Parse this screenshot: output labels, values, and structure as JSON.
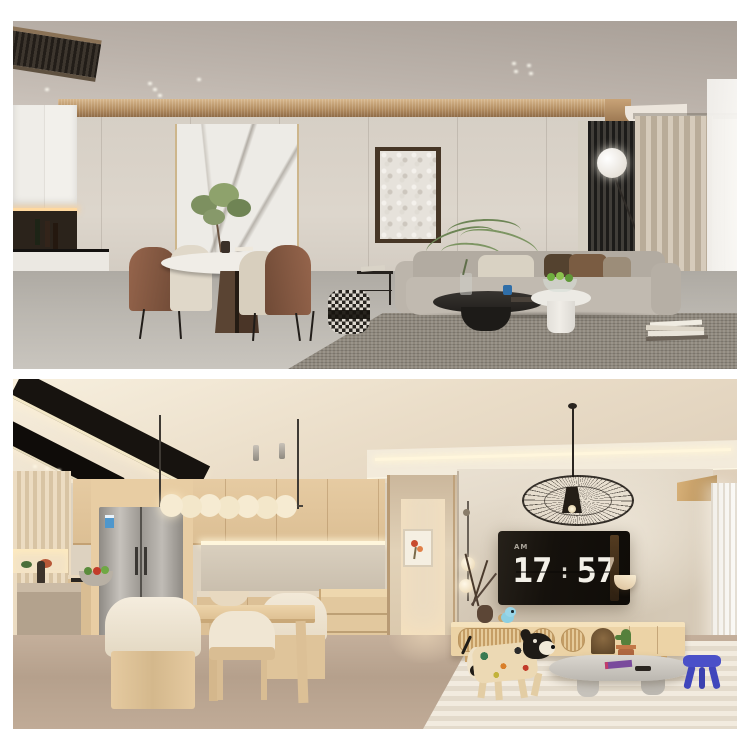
{
  "canvas": {
    "background": "#ffffff"
  },
  "photo_top": {
    "colors": {
      "ceiling": "#b7aea6",
      "wall": "#d9d2c8",
      "wood_cornice": "#b8916a",
      "kitchen_cabinets": "#f0eee9",
      "marble_panel": "#edebe6",
      "sofa": "#b9b2a8",
      "pillow_brown": "#6d5440",
      "rug": "#8f887d",
      "floor": "#b6b2ab",
      "slat_panel": "#23211e",
      "curtain": "#c7bbaa",
      "coffee_table": "#2c2925",
      "side_table_white": "#efece6",
      "pouf": "#dcd7cf"
    }
  },
  "photo_bottom": {
    "colors": {
      "ceiling": "#eee2cf",
      "cabinet_wood": "#e0c49c",
      "wall_plaster": "#ded3c2",
      "hallway": "#d8c6aa",
      "floor": "#b9a38f",
      "fridge": "#b4b0aa",
      "tv_screen": "#16120d",
      "clock_digits": "#f3f0e8",
      "console_wood": "#ecd3a6",
      "rug": "#ece4d6",
      "stool_blue": "#4a50c8",
      "cactus_pot": "#b06840"
    },
    "tv_clock": {
      "meridiem": "AM",
      "hours": "17",
      "separator": ":",
      "minutes": "57"
    }
  }
}
